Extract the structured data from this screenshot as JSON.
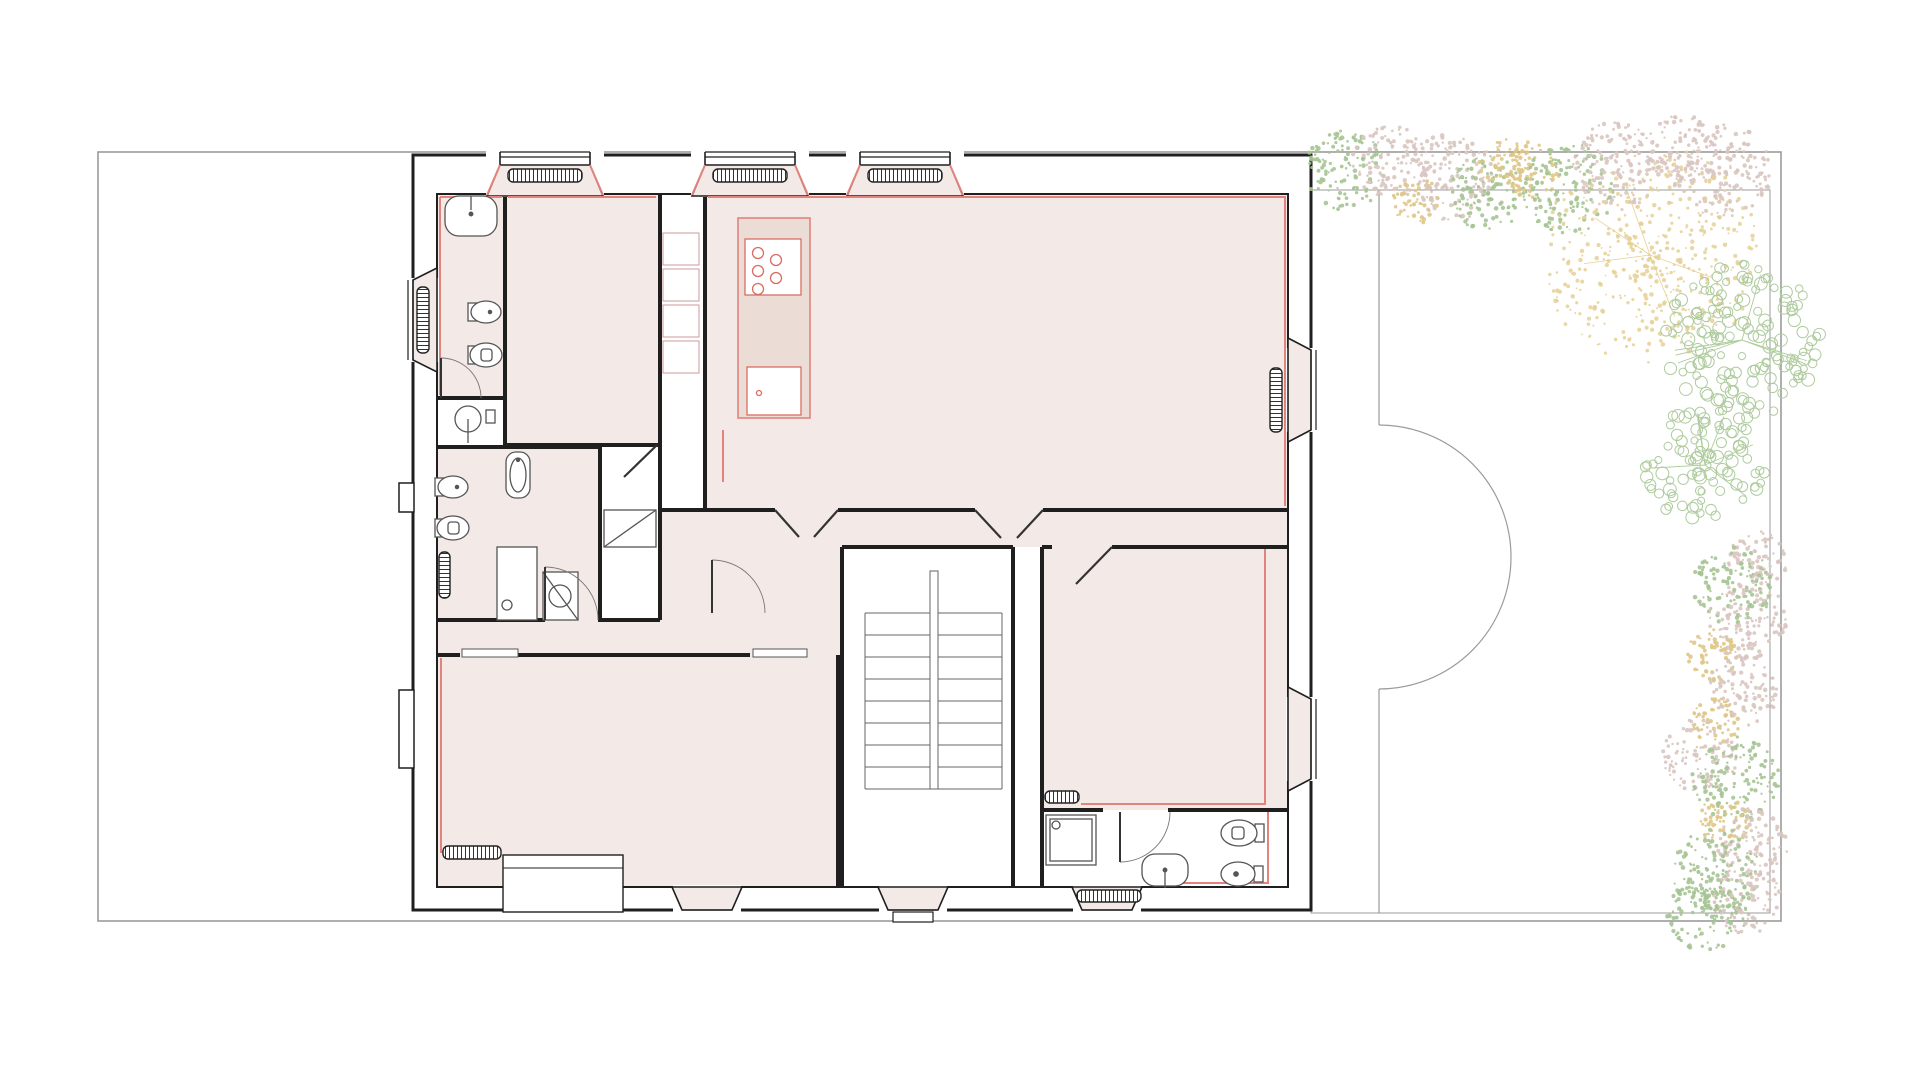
{
  "palette": {
    "wall": "#1f1f1f",
    "thin": "#9b9b9b",
    "fixture": "#555555",
    "room_fill": "#f3eae7",
    "island_fill": "#ebddd6",
    "red": "#e2837d",
    "stove_red": "#d96c63",
    "tree_green": "#a6c493",
    "tree_pink": "#d9c5c0",
    "tree_yellow": "#dfc687",
    "tree_ring_green": "#aecb9d",
    "tree_scatter_yellow": "#e5d095"
  },
  "lot": {
    "x": 98,
    "y": 152,
    "w": 1683,
    "h": 769
  },
  "garden": {
    "inner_rect": {
      "x": 1311,
      "y": 190,
      "w": 459,
      "h": 723
    },
    "terrace_line_x": 1379,
    "terrace_top_y": 190,
    "arc_top": 425,
    "arc_bottom": 689,
    "arc_r": 132,
    "terrace_bottom_y": 913
  },
  "rooms": [
    {
      "name": "bathroom-1",
      "x": 437,
      "y": 194,
      "w": 68,
      "h": 204
    },
    {
      "name": "bedroom-1",
      "x": 505,
      "y": 194,
      "w": 155,
      "h": 251
    },
    {
      "name": "bathroom-2",
      "x": 437,
      "y": 447,
      "w": 163,
      "h": 173
    },
    {
      "name": "kitchen-living",
      "x": 705,
      "y": 194,
      "w": 583,
      "h": 316
    },
    {
      "name": "vestibule",
      "x": 660,
      "y": 510,
      "w": 182,
      "h": 110
    },
    {
      "name": "hall",
      "x": 842,
      "y": 510,
      "w": 446,
      "h": 37
    },
    {
      "name": "corridor",
      "x": 437,
      "y": 620,
      "w": 405,
      "h": 35
    },
    {
      "name": "living-room",
      "x": 437,
      "y": 655,
      "w": 401,
      "h": 232
    },
    {
      "name": "bedroom-2",
      "x": 1042,
      "y": 547,
      "w": 246,
      "h": 263
    }
  ],
  "walls": [
    {
      "d": "M413,155 H1311 V910 H413 Z",
      "w": 3
    },
    {
      "d": "M437,194 H1288 V887 H437 Z",
      "w": 2
    },
    {
      "d": "M505,194 V445",
      "w": 4
    },
    {
      "d": "M437,398 H505",
      "w": 4
    },
    {
      "d": "M437,447 H600",
      "w": 4
    },
    {
      "d": "M505,445 H660",
      "w": 4
    },
    {
      "d": "M660,194 V510",
      "w": 4
    },
    {
      "d": "M600,447 V620",
      "w": 4
    },
    {
      "d": "M660,510 V620",
      "w": 4
    },
    {
      "d": "M660,510 H705",
      "w": 4
    },
    {
      "d": "M705,194 V510",
      "w": 4
    },
    {
      "d": "M437,620 H545",
      "w": 4
    },
    {
      "d": "M598,620 H660",
      "w": 4
    },
    {
      "d": "M437,655 H460",
      "w": 4
    },
    {
      "d": "M518,655 H750",
      "w": 4
    },
    {
      "d": "M838,655 V887",
      "w": 4
    },
    {
      "d": "M705,510 H775",
      "w": 4
    },
    {
      "d": "M838,510 H975",
      "w": 4
    },
    {
      "d": "M1043,510 H1288",
      "w": 4
    },
    {
      "d": "M842,547 V887",
      "w": 4
    },
    {
      "d": "M842,547 H1013",
      "w": 4
    },
    {
      "d": "M1013,547 V887",
      "w": 4
    },
    {
      "d": "M1042,547 V887",
      "w": 4
    },
    {
      "d": "M1042,547 H1052",
      "w": 4
    },
    {
      "d": "M1112,547 H1288",
      "w": 4
    },
    {
      "d": "M1042,810 H1103",
      "w": 4
    },
    {
      "d": "M1168,810 H1288",
      "w": 4
    }
  ],
  "notches": [
    [
      399,
      483,
      15,
      29
    ],
    [
      399,
      690,
      15,
      78
    ]
  ],
  "bays": {
    "top": [
      {
        "c": 545
      },
      {
        "c": 750
      },
      {
        "c": 905
      }
    ],
    "west": [
      {
        "c": 320
      }
    ],
    "east": [
      {
        "c": 390
      },
      {
        "c": 739
      }
    ],
    "south_trap": [
      {
        "c": 707,
        "steps": false,
        "rad": false
      },
      {
        "c": 913,
        "steps": true,
        "rad": false
      },
      {
        "c": 1107,
        "steps": false,
        "rad": true
      }
    ],
    "south_rect": {
      "x": 503,
      "y": 855,
      "w": 120,
      "h": 57,
      "midline_y": 868
    }
  },
  "radiators": [
    [
      508,
      169,
      74,
      13
    ],
    [
      713,
      169,
      74,
      13
    ],
    [
      868,
      169,
      74,
      13
    ],
    [
      417,
      287,
      12,
      66
    ],
    [
      439,
      552,
      11,
      46
    ],
    [
      1270,
      368,
      12,
      64
    ],
    [
      443,
      846,
      58,
      13
    ],
    [
      1045,
      791,
      34,
      12
    ],
    [
      1077,
      890,
      64,
      12
    ]
  ],
  "red_lines": [
    "M440,197 H502",
    "M440,197 V395",
    "M508,197 H656",
    "M708,197 H1285 V506",
    "M723,430 V482",
    "M1265,549 V804 H1081",
    "M441,658 V852 H444",
    "M1268,812 V883 H1150",
    "M590,165 L603,195",
    "M500,165 L487,195",
    "M795,165 L808,195",
    "M705,165 L692,195",
    "M950,165 L963,195",
    "M860,165 L847,195"
  ],
  "island": {
    "x": 738,
    "y": 218,
    "w": 72,
    "h": 200
  },
  "shelves": {
    "x": 663,
    "y": 233,
    "w": 36,
    "h": 32,
    "gap": 4,
    "count": 4
  },
  "fixtures": [
    {
      "t": "sinkTop",
      "x": 471,
      "y": 216
    },
    {
      "t": "bidet",
      "x": 480,
      "y": 312
    },
    {
      "t": "toilet",
      "x": 480,
      "y": 355
    },
    {
      "t": "roundSink",
      "x": 468,
      "y": 419
    },
    {
      "t": "bidet",
      "x": 447,
      "y": 487
    },
    {
      "t": "toilet",
      "x": 447,
      "y": 528
    },
    {
      "t": "tubSmall",
      "x": 506,
      "y": 452
    },
    {
      "t": "shower2",
      "x": 543,
      "y": 572
    },
    {
      "t": "shower3",
      "x": 1046,
      "y": 815
    },
    {
      "t": "toiletH",
      "x": 1243,
      "y": 833
    },
    {
      "t": "bidetH",
      "x": 1242,
      "y": 874
    },
    {
      "t": "sinkBlob",
      "x": 1165,
      "y": 870
    },
    {
      "t": "stove",
      "x": 745,
      "y": 239
    },
    {
      "t": "islandSink",
      "x": 747,
      "y": 367
    },
    {
      "t": "wardrobe",
      "x": 604,
      "y": 510,
      "w": 52,
      "h": 37
    },
    {
      "t": "closet",
      "x": 497,
      "y": 547,
      "w": 40,
      "h": 73
    }
  ],
  "doors": {
    "arcs": [
      {
        "leaf": [
          [
            441,
            398
          ],
          [
            441,
            358
          ]
        ],
        "arc": "M441,358 A40,40 0 0 1 481,398"
      },
      {
        "leaf": [
          [
            545,
            620
          ],
          [
            545,
            567
          ]
        ],
        "arc": "M545,567 A53,53 0 0 1 598,620"
      },
      {
        "leaf": [
          [
            712,
            613
          ],
          [
            712,
            560
          ]
        ],
        "arc": "M712,560 A53,53 0 0 1 765,613"
      },
      {
        "leaf": [
          [
            1120,
            812
          ],
          [
            1120,
            862
          ]
        ],
        "arc": "M1120,862 A50,50 0 0 0 1170,812"
      }
    ],
    "leaves": [
      [
        [
          775,
          510
        ],
        [
          799,
          537
        ]
      ],
      [
        [
          838,
          510
        ],
        [
          814,
          537
        ]
      ],
      [
        [
          975,
          510
        ],
        [
          1001,
          538
        ]
      ],
      [
        [
          1043,
          510
        ],
        [
          1017,
          538
        ]
      ],
      [
        [
          1112,
          547
        ],
        [
          1076,
          584
        ]
      ],
      [
        [
          657,
          445
        ],
        [
          624,
          477
        ]
      ]
    ],
    "sliders": [
      [
        462,
        649,
        56,
        8
      ],
      [
        753,
        649,
        54,
        8
      ]
    ]
  },
  "stairs": {
    "x1": 865,
    "x2": 1002,
    "top": 613,
    "step": 22,
    "n": 8,
    "div_x": 930,
    "div_w": 8,
    "div_y1": 571,
    "div_y2": 789,
    "exit_step": [
      893,
      912,
      40,
      10
    ]
  },
  "trees": [
    {
      "cx": 1345,
      "cy": 170,
      "r": 40,
      "style": "dots",
      "color": "tree_green"
    },
    {
      "cx": 1390,
      "cy": 162,
      "r": 38,
      "style": "dots",
      "color": "tree_pink"
    },
    {
      "cx": 1416,
      "cy": 200,
      "r": 24,
      "style": "dots",
      "color": "tree_yellow"
    },
    {
      "cx": 1452,
      "cy": 177,
      "r": 44,
      "style": "dots",
      "color": "tree_pink"
    },
    {
      "cx": 1487,
      "cy": 194,
      "r": 38,
      "style": "dots",
      "color": "tree_green"
    },
    {
      "cx": 1505,
      "cy": 164,
      "r": 26,
      "style": "dots",
      "color": "tree_yellow"
    },
    {
      "cx": 1532,
      "cy": 170,
      "r": 28,
      "style": "dots",
      "color": "tree_yellow"
    },
    {
      "cx": 1568,
      "cy": 189,
      "r": 46,
      "style": "dots",
      "color": "tree_green"
    },
    {
      "cx": 1616,
      "cy": 166,
      "r": 44,
      "style": "dots",
      "color": "tree_pink"
    },
    {
      "cx": 1682,
      "cy": 151,
      "r": 36,
      "style": "dots",
      "color": "tree_pink"
    },
    {
      "cx": 1724,
      "cy": 172,
      "r": 48,
      "style": "dots",
      "color": "tree_pink"
    },
    {
      "cx": 1650,
      "cy": 255,
      "r": 95,
      "style": "scatter",
      "color": "tree_scatter_yellow"
    },
    {
      "cx": 1742,
      "cy": 340,
      "r": 85,
      "style": "rings",
      "color": "tree_ring_green"
    },
    {
      "cx": 1705,
      "cy": 465,
      "r": 65,
      "style": "rings",
      "color": "tree_ring_green"
    },
    {
      "cx": 1757,
      "cy": 560,
      "r": 30,
      "style": "dots",
      "color": "tree_pink"
    },
    {
      "cx": 1733,
      "cy": 585,
      "r": 40,
      "style": "dots",
      "color": "tree_green"
    },
    {
      "cx": 1747,
      "cy": 620,
      "r": 40,
      "style": "dots",
      "color": "tree_pink"
    },
    {
      "cx": 1713,
      "cy": 655,
      "r": 26,
      "style": "dots",
      "color": "tree_yellow"
    },
    {
      "cx": 1744,
      "cy": 690,
      "r": 36,
      "style": "dots",
      "color": "tree_pink"
    },
    {
      "cx": 1716,
      "cy": 722,
      "r": 24,
      "style": "dots",
      "color": "tree_yellow"
    },
    {
      "cx": 1701,
      "cy": 755,
      "r": 38,
      "style": "dots",
      "color": "tree_pink"
    },
    {
      "cx": 1736,
      "cy": 780,
      "r": 44,
      "style": "dots",
      "color": "tree_green"
    },
    {
      "cx": 1723,
      "cy": 822,
      "r": 26,
      "style": "dots",
      "color": "tree_yellow"
    },
    {
      "cx": 1753,
      "cy": 843,
      "r": 36,
      "style": "dots",
      "color": "tree_pink"
    },
    {
      "cx": 1717,
      "cy": 872,
      "r": 44,
      "style": "dots",
      "color": "tree_green"
    },
    {
      "cx": 1747,
      "cy": 900,
      "r": 34,
      "style": "dots",
      "color": "tree_pink"
    },
    {
      "cx": 1707,
      "cy": 912,
      "r": 40,
      "style": "dots",
      "color": "tree_green"
    }
  ]
}
